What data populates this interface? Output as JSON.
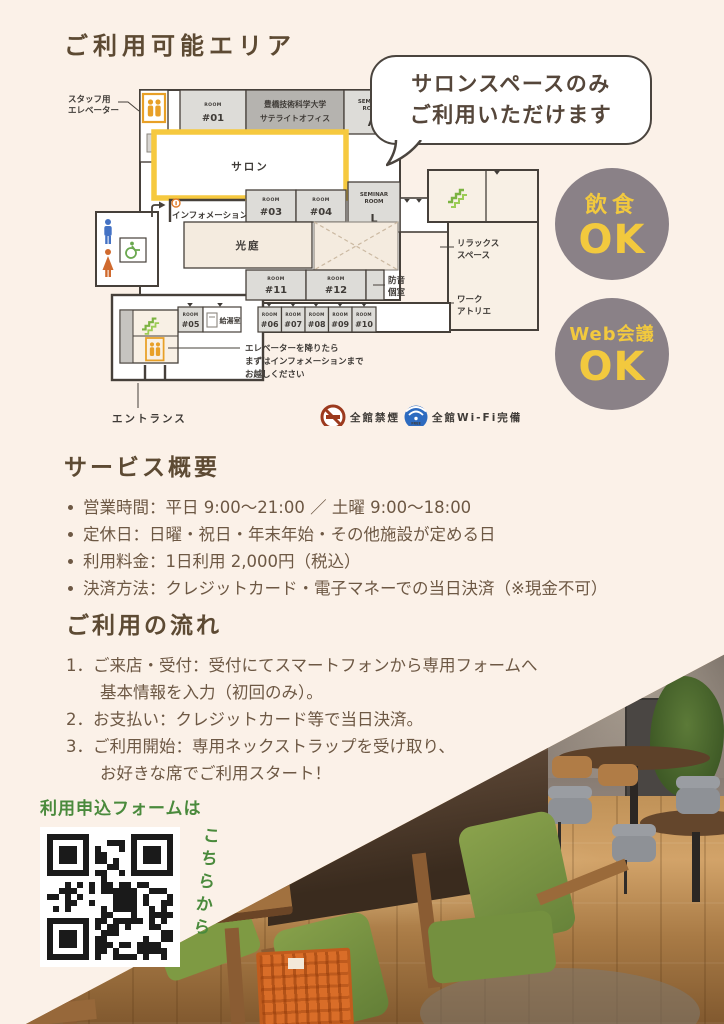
{
  "page": {
    "title": "ご利用可能エリア"
  },
  "bubble": {
    "line1": "サロンスペースのみ",
    "line2": "ご利用いただけます"
  },
  "badges": [
    {
      "label": "飲食",
      "ok": "OK"
    },
    {
      "label": "Web会議",
      "ok": "OK"
    }
  ],
  "map": {
    "room_caption": "ROOM",
    "rooms": {
      "r01": "#01",
      "r03": "#03",
      "r04": "#04",
      "r05": "#05",
      "r06": "#06",
      "r07": "#07",
      "r08": "#08",
      "r09": "#09",
      "r10": "#10",
      "r11": "#11",
      "r12": "#12"
    },
    "labels": {
      "staff_elevator_1": "スタッフ用",
      "staff_elevator_2": "エレベーター",
      "satellite_1": "豊橋技術科学大学",
      "satellite_2": "サテライトオフィス",
      "seminar_caption_1": "SEMINAR",
      "seminar_caption_2": "ROOM",
      "seminar_a": "A",
      "seminar_l": "L",
      "salon": "サロン",
      "information": "インフォメーション",
      "courtyard": "光庭",
      "relax_1": "リラックス",
      "relax_2": "スペース",
      "soundproof_1": "防音",
      "soundproof_2": "個室",
      "atelier_1": "ワーク",
      "atelier_2": "アトリエ",
      "kitchenette": "給湯室",
      "note_1": "エレベーターを降りたら",
      "note_2": "まずはインフォメーションまで",
      "note_3": "お越しください",
      "entrance": "エントランス",
      "no_smoking": "全館禁煙",
      "wifi": "全館Wi-Fi完備",
      "wifi_free": "FREE"
    }
  },
  "services": {
    "heading": "サービス概要",
    "items": [
      "営業時間：平日 9:00〜21:00 ／ 土曜 9:00〜18:00",
      "定休日：日曜・祝日・年末年始・その他施設が定める日",
      "利用料金：1日利用 2,000円（税込）",
      "決済方法：クレジットカード・電子マネーでの当日決済（※現金不可）"
    ]
  },
  "flow": {
    "heading": "ご利用の流れ",
    "lines": [
      "1．ご来店・受付：受付にてスマートフォンから専用フォームへ",
      "基本情報を入力（初回のみ）。",
      "2．お支払い：クレジットカード等で当日決済。",
      "3．ご利用開始：専用ネックストラップを受け取り、",
      "お好きな席でご利用スタート！"
    ]
  },
  "qr": {
    "title": "利用申込フォームは",
    "side": "こちらから"
  },
  "colors": {
    "background": "#fbf1e8",
    "heading_brown": "#5d4a33",
    "accent_yellow": "#f2c93e",
    "badge_gray": "#8a8187",
    "qr_green": "#4a8a3c",
    "salon_highlight": "#f6c93f"
  }
}
